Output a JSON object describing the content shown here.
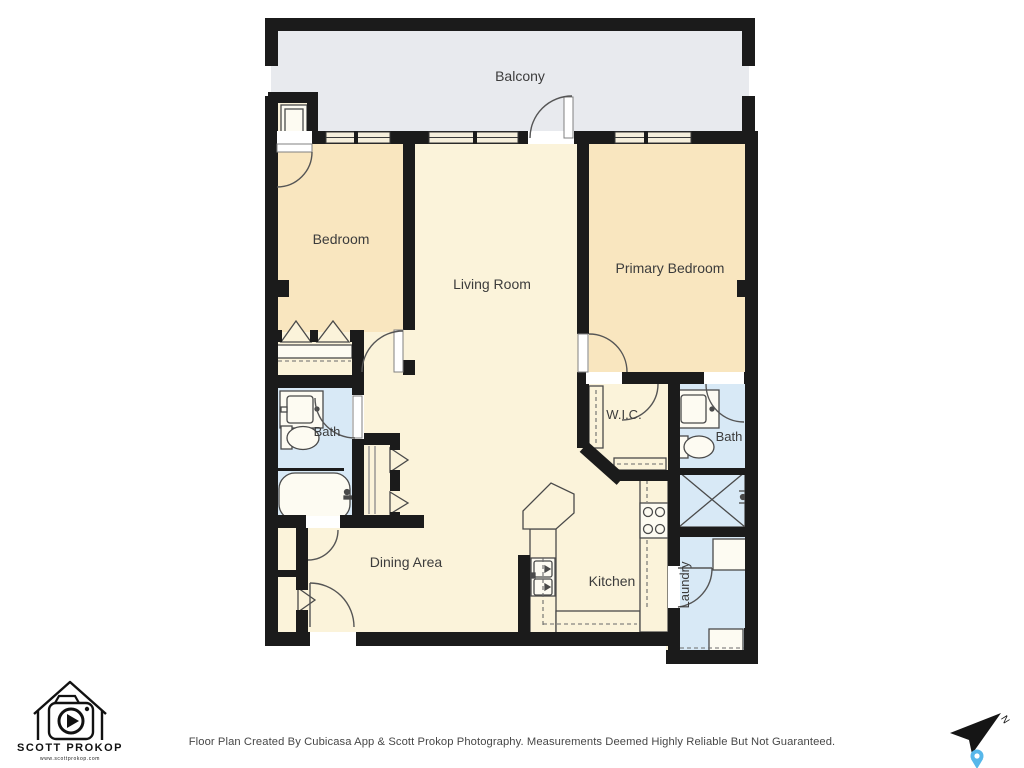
{
  "page": {
    "background": "#ffffff"
  },
  "plan": {
    "rooms": {
      "balcony": "Balcony",
      "bedroom": "Bedroom",
      "living_room": "Living Room",
      "primary_bedroom": "Primary Bedroom",
      "wic": "W.I.C.",
      "bath_left": "Bath",
      "bath_right": "Bath",
      "dining_area": "Dining Area",
      "kitchen": "Kitchen",
      "laundry": "Laundry"
    },
    "colors": {
      "wall": "#1b1b1b",
      "balcony_floor": "#e8eaee",
      "bedroom_floor": "#f9e6bf",
      "main_floor": "#fbf3da",
      "wet_room_floor": "#d8e9f6",
      "label_text": "#3c3c3c"
    }
  },
  "branding": {
    "logo_name": "SCOTT PROKOP",
    "logo_website": "www.scottprokop.com"
  },
  "compass": {
    "north_label": "N",
    "pin_color": "#57b7ea"
  },
  "footer": {
    "disclaimer": "Floor Plan Created By Cubicasa App & Scott Prokop Photography. Measurements Deemed Highly Reliable But Not Guaranteed."
  }
}
